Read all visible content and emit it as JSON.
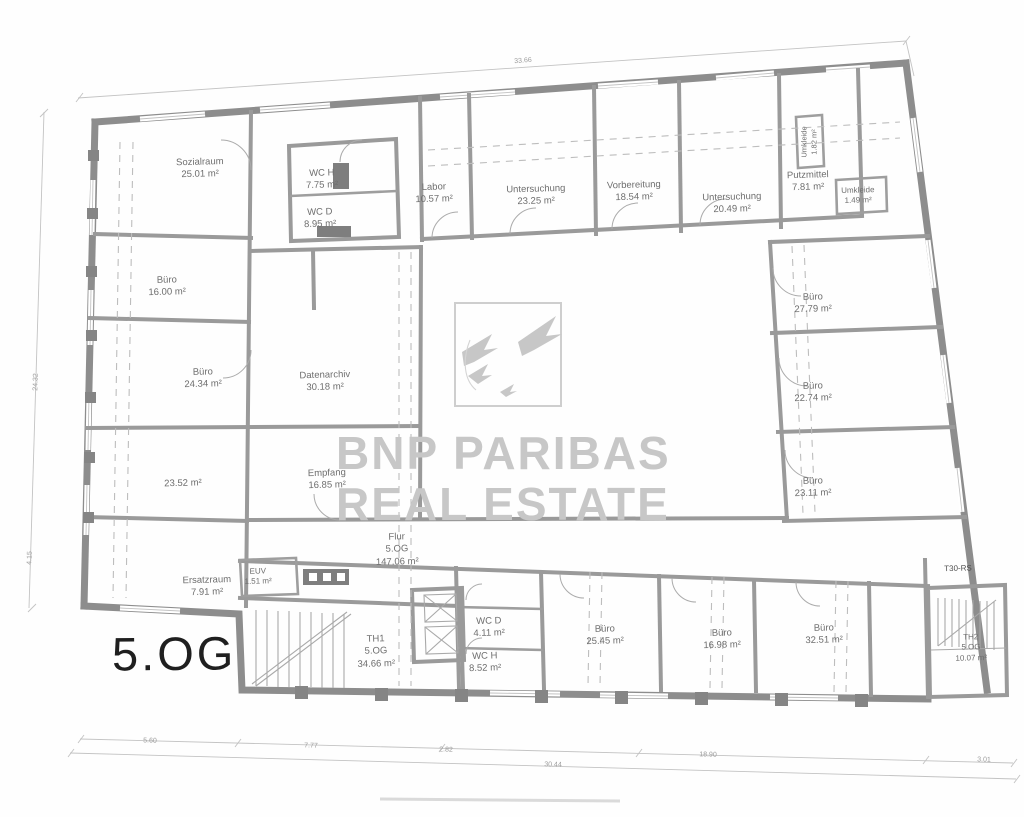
{
  "floor_label": "5.OG",
  "watermark": {
    "logo": "bnp-paribas-birds-logo",
    "line1": "BNP PARIBAS",
    "line2": "REAL ESTATE",
    "color": "#c7c7c7"
  },
  "colors": {
    "wall": "#8d8d8d",
    "inner_wall": "#9a9a9a",
    "label_text": "#6e6e6e",
    "floor_label_text": "#1f1f1f",
    "background": "#fefefe"
  },
  "rooms": {
    "sozialraum": {
      "name": "Sozialraum",
      "area": "25.01 m²"
    },
    "wc_h_top": {
      "name": "WC H",
      "area": "7.75 m²"
    },
    "wc_d_top": {
      "name": "WC D",
      "area": "8.95 m²"
    },
    "labor": {
      "name": "Labor",
      "area": "10.57 m²"
    },
    "untersuchung_1": {
      "name": "Untersuchung",
      "area": "23.25 m²"
    },
    "vorbereitung": {
      "name": "Vorbereitung",
      "area": "18.54 m²"
    },
    "untersuchung_2": {
      "name": "Untersuchung",
      "area": "20.49 m²"
    },
    "putzmittel": {
      "name": "Putzmittel",
      "area": "7.81 m²"
    },
    "umkleide_klein": {
      "name": "Umkleide",
      "area": "1.49 m²"
    },
    "umkleide_vertikal": {
      "name": "Umkleide",
      "area": "1.82 m²"
    },
    "buero_16_00": {
      "name": "Büro",
      "area": "16.00 m²"
    },
    "buero_24_34": {
      "name": "Büro",
      "area": "24.34 m²"
    },
    "datenarchiv": {
      "name": "Datenarchiv",
      "area": "30.18 m²"
    },
    "buero_27_79": {
      "name": "Büro",
      "area": "27.79 m²"
    },
    "buero_22_74": {
      "name": "Büro",
      "area": "22.74 m²"
    },
    "buero_23_11": {
      "name": "Büro",
      "area": "23.11 m²"
    },
    "raum_23_52": {
      "area": "23.52 m²"
    },
    "empfang": {
      "name": "Empfang",
      "area": "16.85 m²"
    },
    "ersatzraum": {
      "name": "Ersatzraum",
      "area": "7.91 m²"
    },
    "euv": {
      "name": "EUV",
      "area": "1.51 m²"
    },
    "flur": {
      "name": "Flur",
      "floor": "5.OG",
      "area": "147.06 m²"
    },
    "th1": {
      "name": "TH1",
      "floor": "5.OG",
      "area": "34.66 m²"
    },
    "wc_d_unten": {
      "name": "WC D",
      "area": "4.11 m²"
    },
    "wc_h_unten": {
      "name": "WC H",
      "area": "8.52 m²"
    },
    "buero_25_45": {
      "name": "Büro",
      "area": "25.45 m²"
    },
    "buero_16_98": {
      "name": "Büro",
      "area": "16.98 m²"
    },
    "buero_32_51": {
      "name": "Büro",
      "area": "32.51 m²"
    },
    "t30_rs": {
      "name": "T30-RS"
    },
    "th2": {
      "name": "TH2",
      "floor": "5.OG",
      "area": "10.07 m²"
    }
  },
  "dimensions": {
    "top_width": "33.66",
    "left_height": "24.32",
    "left_lower": "4.15",
    "bottom_segments": [
      "5.60",
      "7.77",
      "2.82",
      "18.90",
      "3.01"
    ],
    "bottom_total": "30.44"
  }
}
